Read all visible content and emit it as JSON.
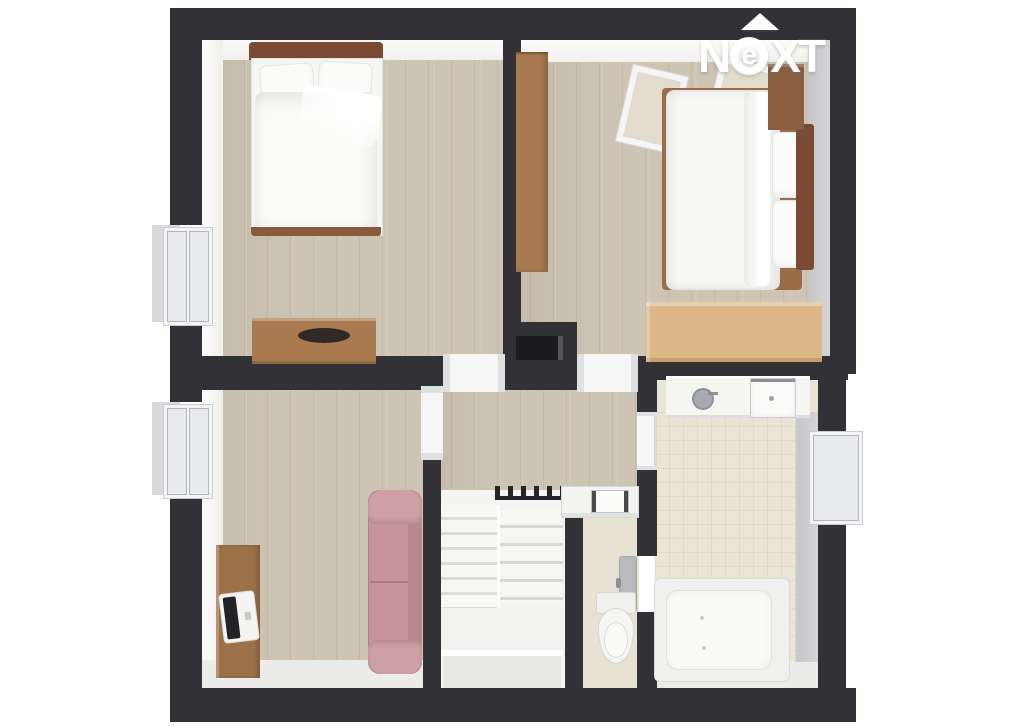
{
  "logo": {
    "brand": "NeXT",
    "letters": [
      "N",
      "e",
      "X",
      "T"
    ],
    "arrow_icon": "up-arrow",
    "color": "#ffffff"
  },
  "scene": {
    "type": "3d-floorplan-top-view",
    "background": "#ffffff"
  },
  "palette": {
    "wall_dark": "#313136",
    "wood_floor": "#cec4b3",
    "tile_floor": "#e9e4d4",
    "white_surface": "#f5f5f4",
    "exterior_gray": "#d9d9db",
    "interior_gray_strip": "#cdcdcf",
    "sofa_pink": "#c6959c",
    "furniture_brown": "#a97a4f",
    "headboard_brown": "#7b4a33",
    "oak_light": "#dcb687",
    "door_gray": "#b9babd"
  },
  "rooms": [
    {
      "name": "bedroom-top-left",
      "furniture": [
        "double-bed",
        "pillows",
        "duvet",
        "dresser",
        "window"
      ]
    },
    {
      "name": "bedroom-top-right",
      "furniture": [
        "double-bed",
        "pillows",
        "roof-window",
        "roof-window",
        "wardrobe",
        "wall-cabinet",
        "chest-of-drawers"
      ]
    },
    {
      "name": "study-bottom-left",
      "furniture": [
        "desk",
        "laptop",
        "sofa",
        "window"
      ]
    },
    {
      "name": "hallway-landing",
      "furniture": [
        "staircase",
        "stair-railing"
      ]
    },
    {
      "name": "wc",
      "furniture": [
        "toilet",
        "washbasin",
        "door"
      ]
    },
    {
      "name": "bathroom",
      "furniture": [
        "bathtub",
        "vanity-sink",
        "faucet",
        "square-sink",
        "window",
        "door"
      ]
    },
    {
      "name": "chimney",
      "furniture": [
        "flue-opening"
      ]
    }
  ]
}
